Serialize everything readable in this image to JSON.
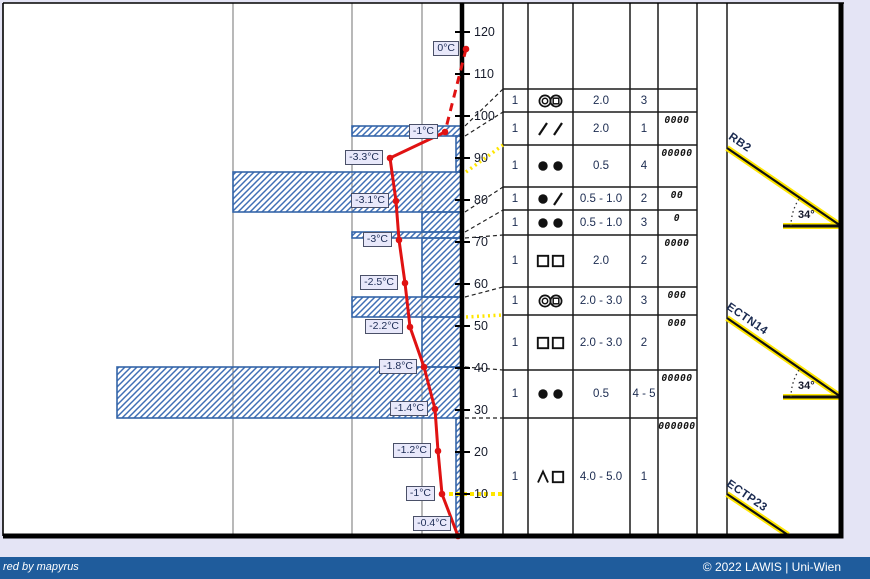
{
  "page": {
    "width": 870,
    "height": 579,
    "bg": "#e4e4f5"
  },
  "footer": {
    "left_text": "red by mapyrus",
    "right_text": "© 2022 LAWIS | Uni-Wien",
    "bar_color": "#1f5c9c",
    "text_color": "#ffffff",
    "bar_top": 557,
    "bar_height": 22
  },
  "colors": {
    "frame": "#000000",
    "grid": "#8a8a8a",
    "axis": "#000000",
    "bar_border": "#3565a8",
    "bar_hatch": "#3f6fb5",
    "temp_line": "#e01212",
    "connector": "#222222",
    "flag_yellow": "#ffe600",
    "test_yellow": "#ffe600",
    "test_black": "#111111",
    "symbol_ink": "#111111"
  },
  "geometry": {
    "frame": {
      "left": 3,
      "top": 3,
      "right": 841,
      "bottom": 536
    },
    "gridlines_x": [
      233,
      352,
      422
    ],
    "axis_x": 462,
    "bar_right_x": 461,
    "tick_x1": 455,
    "tick_x2": 470,
    "tick_label_x": 474,
    "table_col_x": [
      503,
      528,
      573,
      630,
      658,
      697,
      727
    ],
    "table_row_y": [
      89,
      112,
      145,
      187,
      210,
      235,
      287,
      315,
      370,
      418,
      536
    ],
    "symbol_col": {
      "left": 528,
      "width": 45
    },
    "col1_center": 515,
    "size_center": 601,
    "col4_center": 644,
    "zeros_center": 677
  },
  "chart_data": {
    "type": "snow-profile",
    "y_axis": {
      "unit": "cm",
      "ticks": [
        120,
        110,
        100,
        90,
        80,
        70,
        60,
        50,
        40,
        30,
        20,
        10
      ],
      "y0_px": 536,
      "px_per_cm": 4.2
    },
    "temperature_curve": {
      "unit": "°C",
      "points": [
        {
          "label": "0°C",
          "value": 0,
          "x": 466,
          "y": 49,
          "dashed_to_next": true
        },
        {
          "label": "-1°C",
          "value": -1,
          "x": 445,
          "y": 132
        },
        {
          "label": "-3.3°C",
          "value": -3.3,
          "x": 390,
          "y": 158
        },
        {
          "label": "-3.1°C",
          "value": -3.1,
          "x": 396,
          "y": 201
        },
        {
          "label": "-3°C",
          "value": -3,
          "x": 399,
          "y": 240
        },
        {
          "label": "-2.5°C",
          "value": -2.5,
          "x": 405,
          "y": 283
        },
        {
          "label": "-2.2°C",
          "value": -2.2,
          "x": 410,
          "y": 327
        },
        {
          "label": "-1.8°C",
          "value": -1.8,
          "x": 424,
          "y": 367
        },
        {
          "label": "-1.4°C",
          "value": -1.4,
          "x": 435,
          "y": 409
        },
        {
          "label": "-1.2°C",
          "value": -1.2,
          "x": 438,
          "y": 451
        },
        {
          "label": "-1°C",
          "value": -1,
          "x": 442,
          "y": 494
        },
        {
          "label": "-0.4°C",
          "value": -0.4,
          "x": 458,
          "y": 536,
          "label_dy": -12
        }
      ]
    },
    "hardness_bars": [
      {
        "top_cm": 97,
        "bottom_cm": 95,
        "y_top": 126,
        "y_bottom": 136,
        "x_left": 352
      },
      {
        "top_cm": 95,
        "bottom_cm": 86.5,
        "y_top": 136,
        "y_bottom": 172,
        "x_left": 456
      },
      {
        "top_cm": 86.5,
        "bottom_cm": 77,
        "y_top": 172,
        "y_bottom": 212,
        "x_left": 233
      },
      {
        "top_cm": 77,
        "bottom_cm": 72.5,
        "y_top": 212,
        "y_bottom": 232,
        "x_left": 422
      },
      {
        "top_cm": 72.5,
        "bottom_cm": 71,
        "y_top": 232,
        "y_bottom": 238,
        "x_left": 352
      },
      {
        "top_cm": 71,
        "bottom_cm": 57,
        "y_top": 238,
        "y_bottom": 297,
        "x_left": 422
      },
      {
        "top_cm": 57,
        "bottom_cm": 52,
        "y_top": 297,
        "y_bottom": 317,
        "x_left": 352
      },
      {
        "top_cm": 52,
        "bottom_cm": 40,
        "y_top": 317,
        "y_bottom": 367,
        "x_left": 422
      },
      {
        "top_cm": 40,
        "bottom_cm": 28,
        "y_top": 367,
        "y_bottom": 418,
        "x_left": 117
      },
      {
        "top_cm": 28,
        "bottom_cm": 0,
        "y_top": 418,
        "y_bottom": 536,
        "x_left": 456
      }
    ],
    "layer_connectors": [
      {
        "row_y": 89,
        "axis_y": 126,
        "style": "dashed"
      },
      {
        "row_y": 112,
        "axis_y": 136,
        "style": "dashed"
      },
      {
        "row_y": 145,
        "axis_y": 172,
        "style": "yellow"
      },
      {
        "row_y": 187,
        "axis_y": 212,
        "style": "dashed"
      },
      {
        "row_y": 210,
        "axis_y": 232,
        "style": "dashed"
      },
      {
        "row_y": 235,
        "axis_y": 238,
        "style": "dashed"
      },
      {
        "row_y": 287,
        "axis_y": 297,
        "style": "dashed"
      },
      {
        "row_y": 315,
        "axis_y": 317,
        "style": "yellow"
      },
      {
        "row_y": 370,
        "axis_y": 367,
        "style": "dashed"
      },
      {
        "row_y": 418,
        "axis_y": 418,
        "style": "dashed"
      }
    ],
    "flag_10cm": {
      "y": 494,
      "x1": 449,
      "x2": 503
    },
    "layers_table": {
      "rows": [
        {
          "wetness": "1",
          "symbols": [
            "circle-circle",
            "circle-square"
          ],
          "grain_size": "2.0",
          "hardness": "3"
        },
        {
          "wetness": "1",
          "symbols": [
            "slash",
            "slash"
          ],
          "grain_size": "2.0",
          "hardness": "1"
        },
        {
          "wetness": "1",
          "symbols": [
            "dot",
            "dot"
          ],
          "grain_size": "0.5",
          "hardness": "4"
        },
        {
          "wetness": "1",
          "symbols": [
            "dot",
            "slash"
          ],
          "grain_size": "0.5 - 1.0",
          "hardness": "2"
        },
        {
          "wetness": "1",
          "symbols": [
            "dot",
            "dot"
          ],
          "grain_size": "0.5 - 1.0",
          "hardness": "3"
        },
        {
          "wetness": "1",
          "symbols": [
            "square",
            "square"
          ],
          "grain_size": "2.0",
          "hardness": "2"
        },
        {
          "wetness": "1",
          "symbols": [
            "circle-circle",
            "circle-square"
          ],
          "grain_size": "2.0 - 3.0",
          "hardness": "3"
        },
        {
          "wetness": "1",
          "symbols": [
            "square",
            "square"
          ],
          "grain_size": "2.0 - 3.0",
          "hardness": "2"
        },
        {
          "wetness": "1",
          "symbols": [
            "dot",
            "dot"
          ],
          "grain_size": "0.5",
          "hardness": "4 - 5"
        },
        {
          "wetness": "1",
          "symbols": [
            "caret",
            "square"
          ],
          "grain_size": "4.0 - 5.0",
          "hardness": "1"
        }
      ]
    },
    "moisture_column": [
      {
        "row": 2,
        "zeros": 4
      },
      {
        "row": 3,
        "zeros": 5
      },
      {
        "row": 4,
        "zeros": 2
      },
      {
        "row": 5,
        "zeros": 1
      },
      {
        "row": 6,
        "zeros": 4
      },
      {
        "row": 7,
        "zeros": 3
      },
      {
        "row": 8,
        "zeros": 3
      },
      {
        "row": 9,
        "zeros": 5
      },
      {
        "row": 10,
        "zeros": 6
      }
    ],
    "stability_tests": [
      {
        "name": "RB2",
        "angle_label": "34°",
        "diag": [
          727,
          148,
          841,
          226
        ],
        "horiz": [
          783,
          226,
          841,
          226
        ],
        "name_pos": [
          733,
          131
        ],
        "angle_pos": [
          798,
          209
        ]
      },
      {
        "name": "ECTN14",
        "angle_label": "34°",
        "diag": [
          727,
          318,
          841,
          397
        ],
        "horiz": [
          783,
          397,
          841,
          397
        ],
        "name_pos": [
          731,
          301
        ],
        "angle_pos": [
          798,
          380
        ]
      },
      {
        "name": "ECTP23",
        "angle_label": "",
        "diag": [
          727,
          494,
          788,
          535
        ],
        "horiz": null,
        "name_pos": [
          731,
          478
        ],
        "angle_pos": null
      }
    ]
  }
}
